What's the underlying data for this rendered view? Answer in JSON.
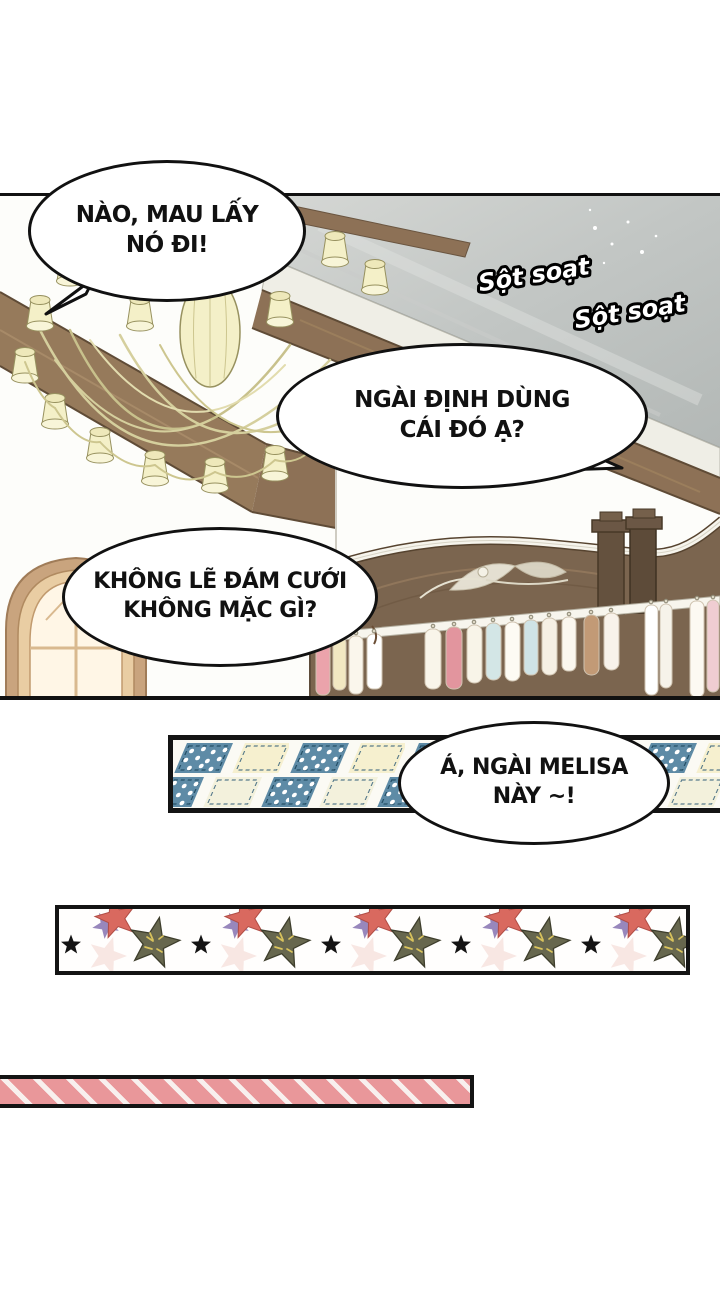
{
  "page": {
    "type": "manhwa-comic-page",
    "language": "vi"
  },
  "bubbles": {
    "b1": {
      "line1": "NÀO, MAU LẤY",
      "line2": "NÓ ĐI!"
    },
    "b2": {
      "line1": "NGÀI ĐỊNH DÙNG",
      "line2": "CÁI ĐÓ Ạ?"
    },
    "b3": {
      "line1": "KHÔNG LẼ ĐÁM CƯỚI",
      "line2": "KHÔNG MẶC GÌ?"
    },
    "b4": {
      "line1": "Á, NGÀI MELISA",
      "line2": "NÀY ~!"
    }
  },
  "sfx": {
    "sfx1": "Sột soạt",
    "sfx2": "Sột soạt"
  },
  "colors": {
    "panel_border": "#111111",
    "beam_brown": "#8d7156",
    "wardrobe_brown": "#7b654f",
    "chandelier_cream": "#f4f0c8",
    "mirror_gray": "#c6c9c7",
    "strip_blue": "#5e8ba6",
    "strip_cream": "#f6f0cf",
    "strip_pink": "#e9979a",
    "star_red": "#d9695f",
    "star_olive": "#67674e"
  }
}
